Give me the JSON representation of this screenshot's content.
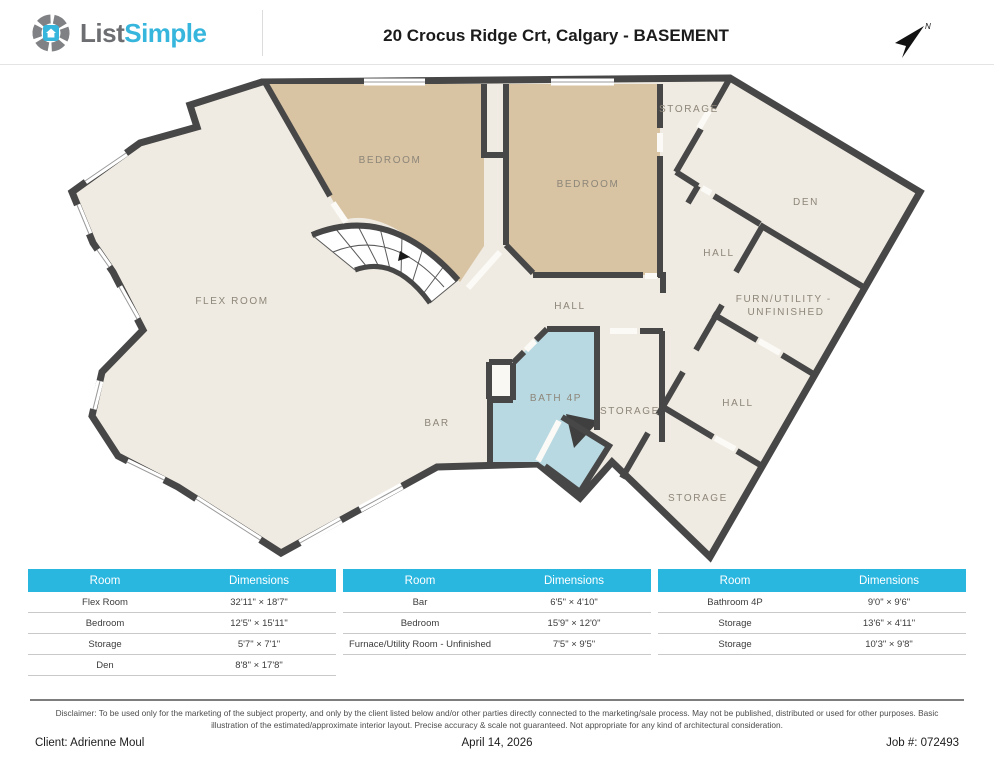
{
  "header": {
    "logo_part1": "List",
    "logo_part2": "Simple",
    "title": "20 Crocus Ridge Crt, Calgary - BASEMENT",
    "compass_label": "N"
  },
  "plan": {
    "labels": {
      "flex_room": "FLEX ROOM",
      "bedroom_left": "BEDROOM",
      "bedroom_right": "BEDROOM",
      "storage_top": "STORAGE",
      "den": "DEN",
      "hall_upper": "HALL",
      "furn_line1": "FURN/UTILITY -",
      "furn_line2": "UNFINISHED",
      "hall_center": "HALL",
      "bath": "BATH 4P",
      "storage_mid": "STORAGE",
      "hall_lower": "HALL",
      "bar": "BAR",
      "storage_bottom": "STORAGE"
    }
  },
  "tables": [
    {
      "header": {
        "room": "Room",
        "dimensions": "Dimensions"
      },
      "rows": [
        {
          "room": "Flex Room",
          "dim": "32'11\" × 18'7\""
        },
        {
          "room": "Bedroom",
          "dim": "12'5\" × 15'11\""
        },
        {
          "room": "Storage",
          "dim": "5'7\" × 7'1\""
        },
        {
          "room": "Den",
          "dim": "8'8\" × 17'8\""
        }
      ]
    },
    {
      "header": {
        "room": "Room",
        "dimensions": "Dimensions"
      },
      "rows": [
        {
          "room": "Bar",
          "dim": "6'5\" × 4'10\""
        },
        {
          "room": "Bedroom",
          "dim": "15'9\" × 12'0\""
        },
        {
          "room": "Furnace/Utility Room - Unfinished",
          "dim": "7'5\" × 9'5\""
        }
      ]
    },
    {
      "header": {
        "room": "Room",
        "dimensions": "Dimensions"
      },
      "rows": [
        {
          "room": "Bathroom 4P",
          "dim": "9'0\" × 9'6\""
        },
        {
          "room": "Storage",
          "dim": "13'6\" × 4'11\""
        },
        {
          "room": "Storage",
          "dim": "10'3\" × 9'8\""
        }
      ]
    }
  ],
  "disclaimer": "Disclaimer: To be used only for the marketing of the subject property, and only by the client listed below and/or other parties directly connected to the marketing/sale process. May not be published, distributed or used for other purposes. Basic illustration of the estimated/approximate interior layout. Precise accuracy & scale not guaranteed. Not appropriate for any kind of architectural consideration.",
  "footer": {
    "client": "Client: Adrienne Moul",
    "date": "April 14, 2026",
    "job": "Job #: 072493"
  },
  "colors": {
    "accent": "#29b7e0",
    "wall": "#474747",
    "floor": "#f0ebe2",
    "bedroom": "#d8c3a3",
    "bath": "#b9d9e2"
  }
}
